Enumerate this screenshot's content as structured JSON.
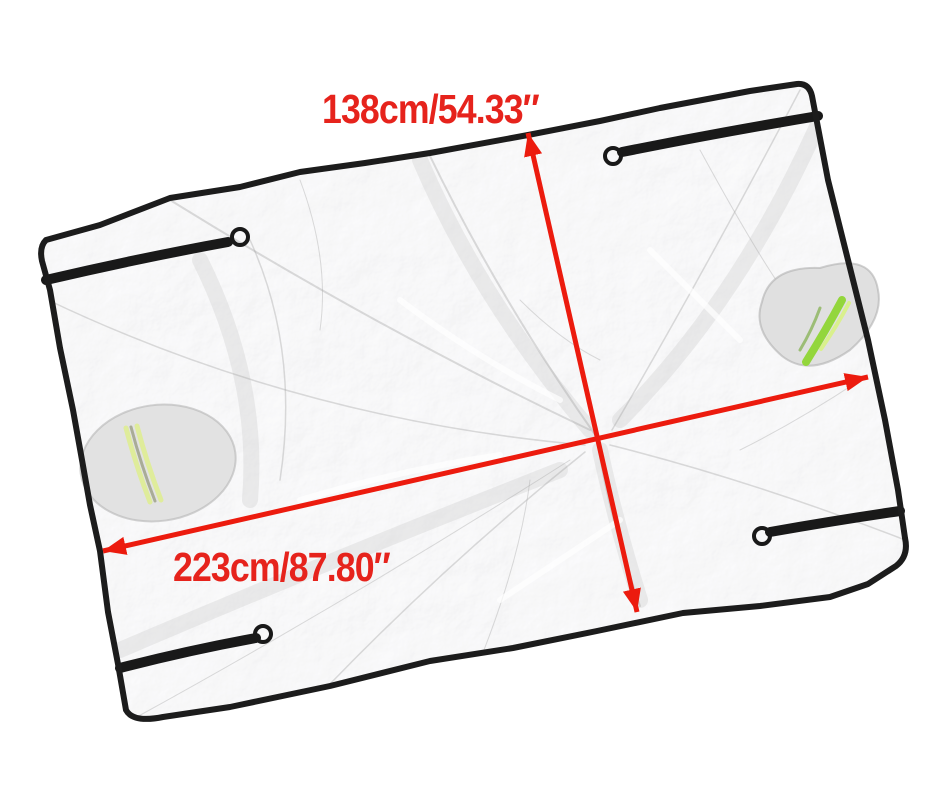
{
  "page": {
    "background_color": "#ffffff"
  },
  "product": {
    "description": "Silver foil car cover sheet with black trim edging, corner straps with rings, and reflective strip pouches",
    "dimensions": {
      "width_label": "138cm/54.33″",
      "length_label": "223cm/87.80″"
    },
    "colors": {
      "arrow_red": "#ec1b0e",
      "label_red": "#e6231c",
      "tarp_silver": "#e9e9e9",
      "trim_black": "#1c1c1c",
      "strap_black": "#191919",
      "reflective_green": "#93d63c",
      "reflective_pale_green": "#dfec9b"
    }
  }
}
